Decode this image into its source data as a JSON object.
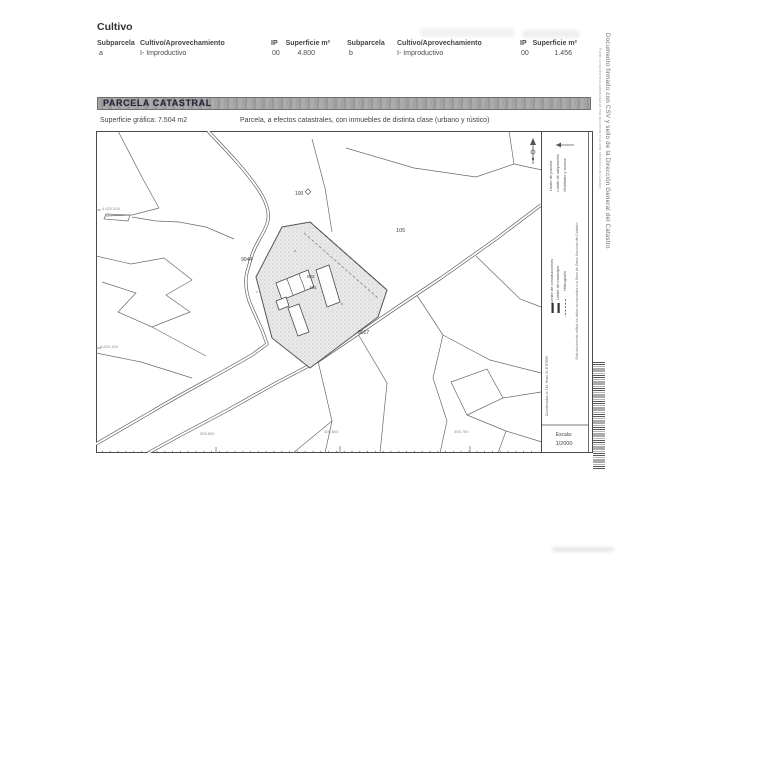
{
  "cultivo": {
    "title": "Cultivo",
    "headers": [
      "Subparcela",
      "Cultivo/Aprovechamiento",
      "IP",
      "Superficie m²",
      "Subparcela",
      "Cultivo/Aprovechamiento",
      "IP",
      "Superficie m²"
    ],
    "row": [
      "a",
      "I- Improductivo",
      "00",
      "4.800",
      "b",
      "I- Improductivo",
      "00",
      "1.456"
    ]
  },
  "parcela": {
    "bar_title": "PARCELA CATASTRAL",
    "superficie": "Superficie gráfica: 7.504 m2",
    "descripcion": "Parcela, a efectos catastrales, con inmuebles de distinta clase (urbano y rústico)"
  },
  "map": {
    "labels": {
      "p100": "100",
      "p105": "105",
      "p9044": "9044",
      "b002": "002",
      "b101": "101",
      "p9017": "9017"
    },
    "coords_left": [
      "4.620.200",
      "4.620.100"
    ],
    "coords_bottom": [
      "305.500",
      "305.600",
      "305.700"
    ],
    "legend": {
      "items": [
        "Límite de parcela",
        "Límite de subparcela",
        "Mobiliario y aceras",
        "Límite de construcciones",
        "Límite de municipio",
        "Hidrografía"
      ],
      "utm_note": "Coordenadas U.T.M. Huso 31 ETRS89",
      "note": "Este documento refleja los datos incorporados a la Base de Datos Nacional del Catastro",
      "scale_label": "Escala:",
      "scale_value": "1/2000"
    }
  },
  "margin": {
    "signature": "Documento firmado con CSV y sello de la Dirección General del Catastro",
    "verification": "Puede comprobarse la autenticidad de este documento en la sede electrónica del Catastro"
  }
}
